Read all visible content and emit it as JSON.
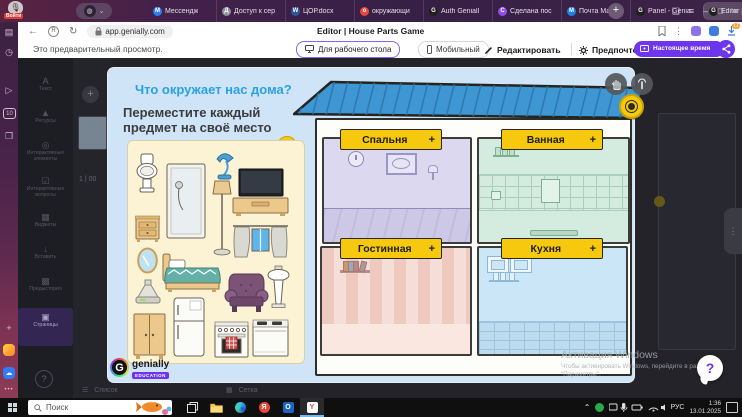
{
  "browser": {
    "login": "Войти",
    "profile_glyph": "◍",
    "profile_chevron": "⌄",
    "tabs": {
      "items": [
        {
          "label": "Мессендж",
          "glyph": "М",
          "icon_color": "#2f7df6"
        },
        {
          "label": "Доступ к сер",
          "glyph": "Д",
          "icon_color": "#8d9199"
        },
        {
          "label": "ЦОР.docx",
          "glyph": "W",
          "icon_color": "#2b579a"
        },
        {
          "label": "окружающи",
          "glyph": "о",
          "icon_color": "#e8453c"
        },
        {
          "label": "Auth Geniall",
          "glyph": "G",
          "icon_color": "#1f1f1f"
        },
        {
          "label": "Сделана пос",
          "glyph": "С",
          "icon_color": "#8f4fe8"
        },
        {
          "label": "Почта Mail",
          "glyph": "М",
          "icon_color": "#1a82e2"
        },
        {
          "label": "Panel - Genia",
          "glyph": "G",
          "icon_color": "#1f1f1f"
        },
        {
          "label": "Editor | Ho...",
          "glyph": "G",
          "icon_color": "#1f1f1f"
        }
      ],
      "active_index": 8,
      "close_glyph": "×",
      "new_tab": "+"
    },
    "controls": {
      "comments": "❏",
      "menu": "≡",
      "minimize": "–",
      "maximize": "▢",
      "close": "×"
    },
    "address": {
      "url": "app.genially.com",
      "page_title": "Editor | House Parts Game",
      "back": "←",
      "site_info": "R",
      "reload": "↻",
      "more": "⋮",
      "downloads_badge": "11"
    }
  },
  "preview": {
    "note": "Это предварительный просмотр.",
    "desktop": "Для рабочего стола",
    "mobile": "Мобильный",
    "edit": "Редактировать",
    "prefs": "Предпочтения",
    "present": "Настоящее время"
  },
  "editor": {
    "items": [
      {
        "glyph": "A",
        "label": "Текст"
      },
      {
        "glyph": "▲",
        "label": "Ресурсы"
      },
      {
        "glyph": "◎",
        "label": "Интерактивные элементы"
      },
      {
        "glyph": "☑",
        "label": "Интерактивные вопросы"
      },
      {
        "glyph": "▦",
        "label": "Виджеты"
      },
      {
        "glyph": "↓",
        "label": "Вставить"
      },
      {
        "glyph": "▩",
        "label": "Предыстория"
      },
      {
        "glyph": "▣",
        "label": "Страницы"
      }
    ],
    "active_item": "Страницы",
    "help": "?",
    "add_page": "+",
    "page_indicator": "1 | 00",
    "views": {
      "list": "Список",
      "grid": "Сетка"
    }
  },
  "game": {
    "title": "Что окружает нас дома?",
    "instruction": "Переместите каждый предмет на своё место",
    "info": "i",
    "rooms": [
      {
        "name": "Спальня",
        "add": "+",
        "color": "#dbd8f0"
      },
      {
        "name": "Ванная",
        "add": "+",
        "color": "#d3ecdf"
      },
      {
        "name": "Гостинная",
        "add": "+",
        "color": "#f6ded8"
      },
      {
        "name": "Кухня",
        "add": "+",
        "color": "#cbe6f7"
      }
    ],
    "furniture": [
      "toilet",
      "nightstand",
      "mirror",
      "shower",
      "bed",
      "cooker-hood",
      "wardrobe",
      "desk-lamp",
      "floor-lamp",
      "tv-stand",
      "curtains-window",
      "armchair",
      "pedestal-sink",
      "refrigerator",
      "stove",
      "dishwasher"
    ],
    "logo": {
      "brand": "genially",
      "badge": "EDUCATION"
    }
  },
  "assist": {
    "help": "?"
  },
  "windows": {
    "activation": {
      "title": "Активация Windows",
      "line1": "Чтобы активировать Windows, перейдите в раздел",
      "line2": "\"Параметры\"."
    },
    "taskbar": {
      "search": "Поиск",
      "lang": "РУС",
      "time": "1:36",
      "date": "13.01.2025"
    }
  },
  "colors": {
    "genially_purple": "#6d35ee",
    "label_yellow": "#f6c90e",
    "roof_blue": "#3e96d2",
    "modal_blue": "#cfe4f7",
    "cream_panel": "#fbf3d3",
    "tabbar_purple": "#43214a",
    "taskbar_black": "#0f0f0f"
  }
}
